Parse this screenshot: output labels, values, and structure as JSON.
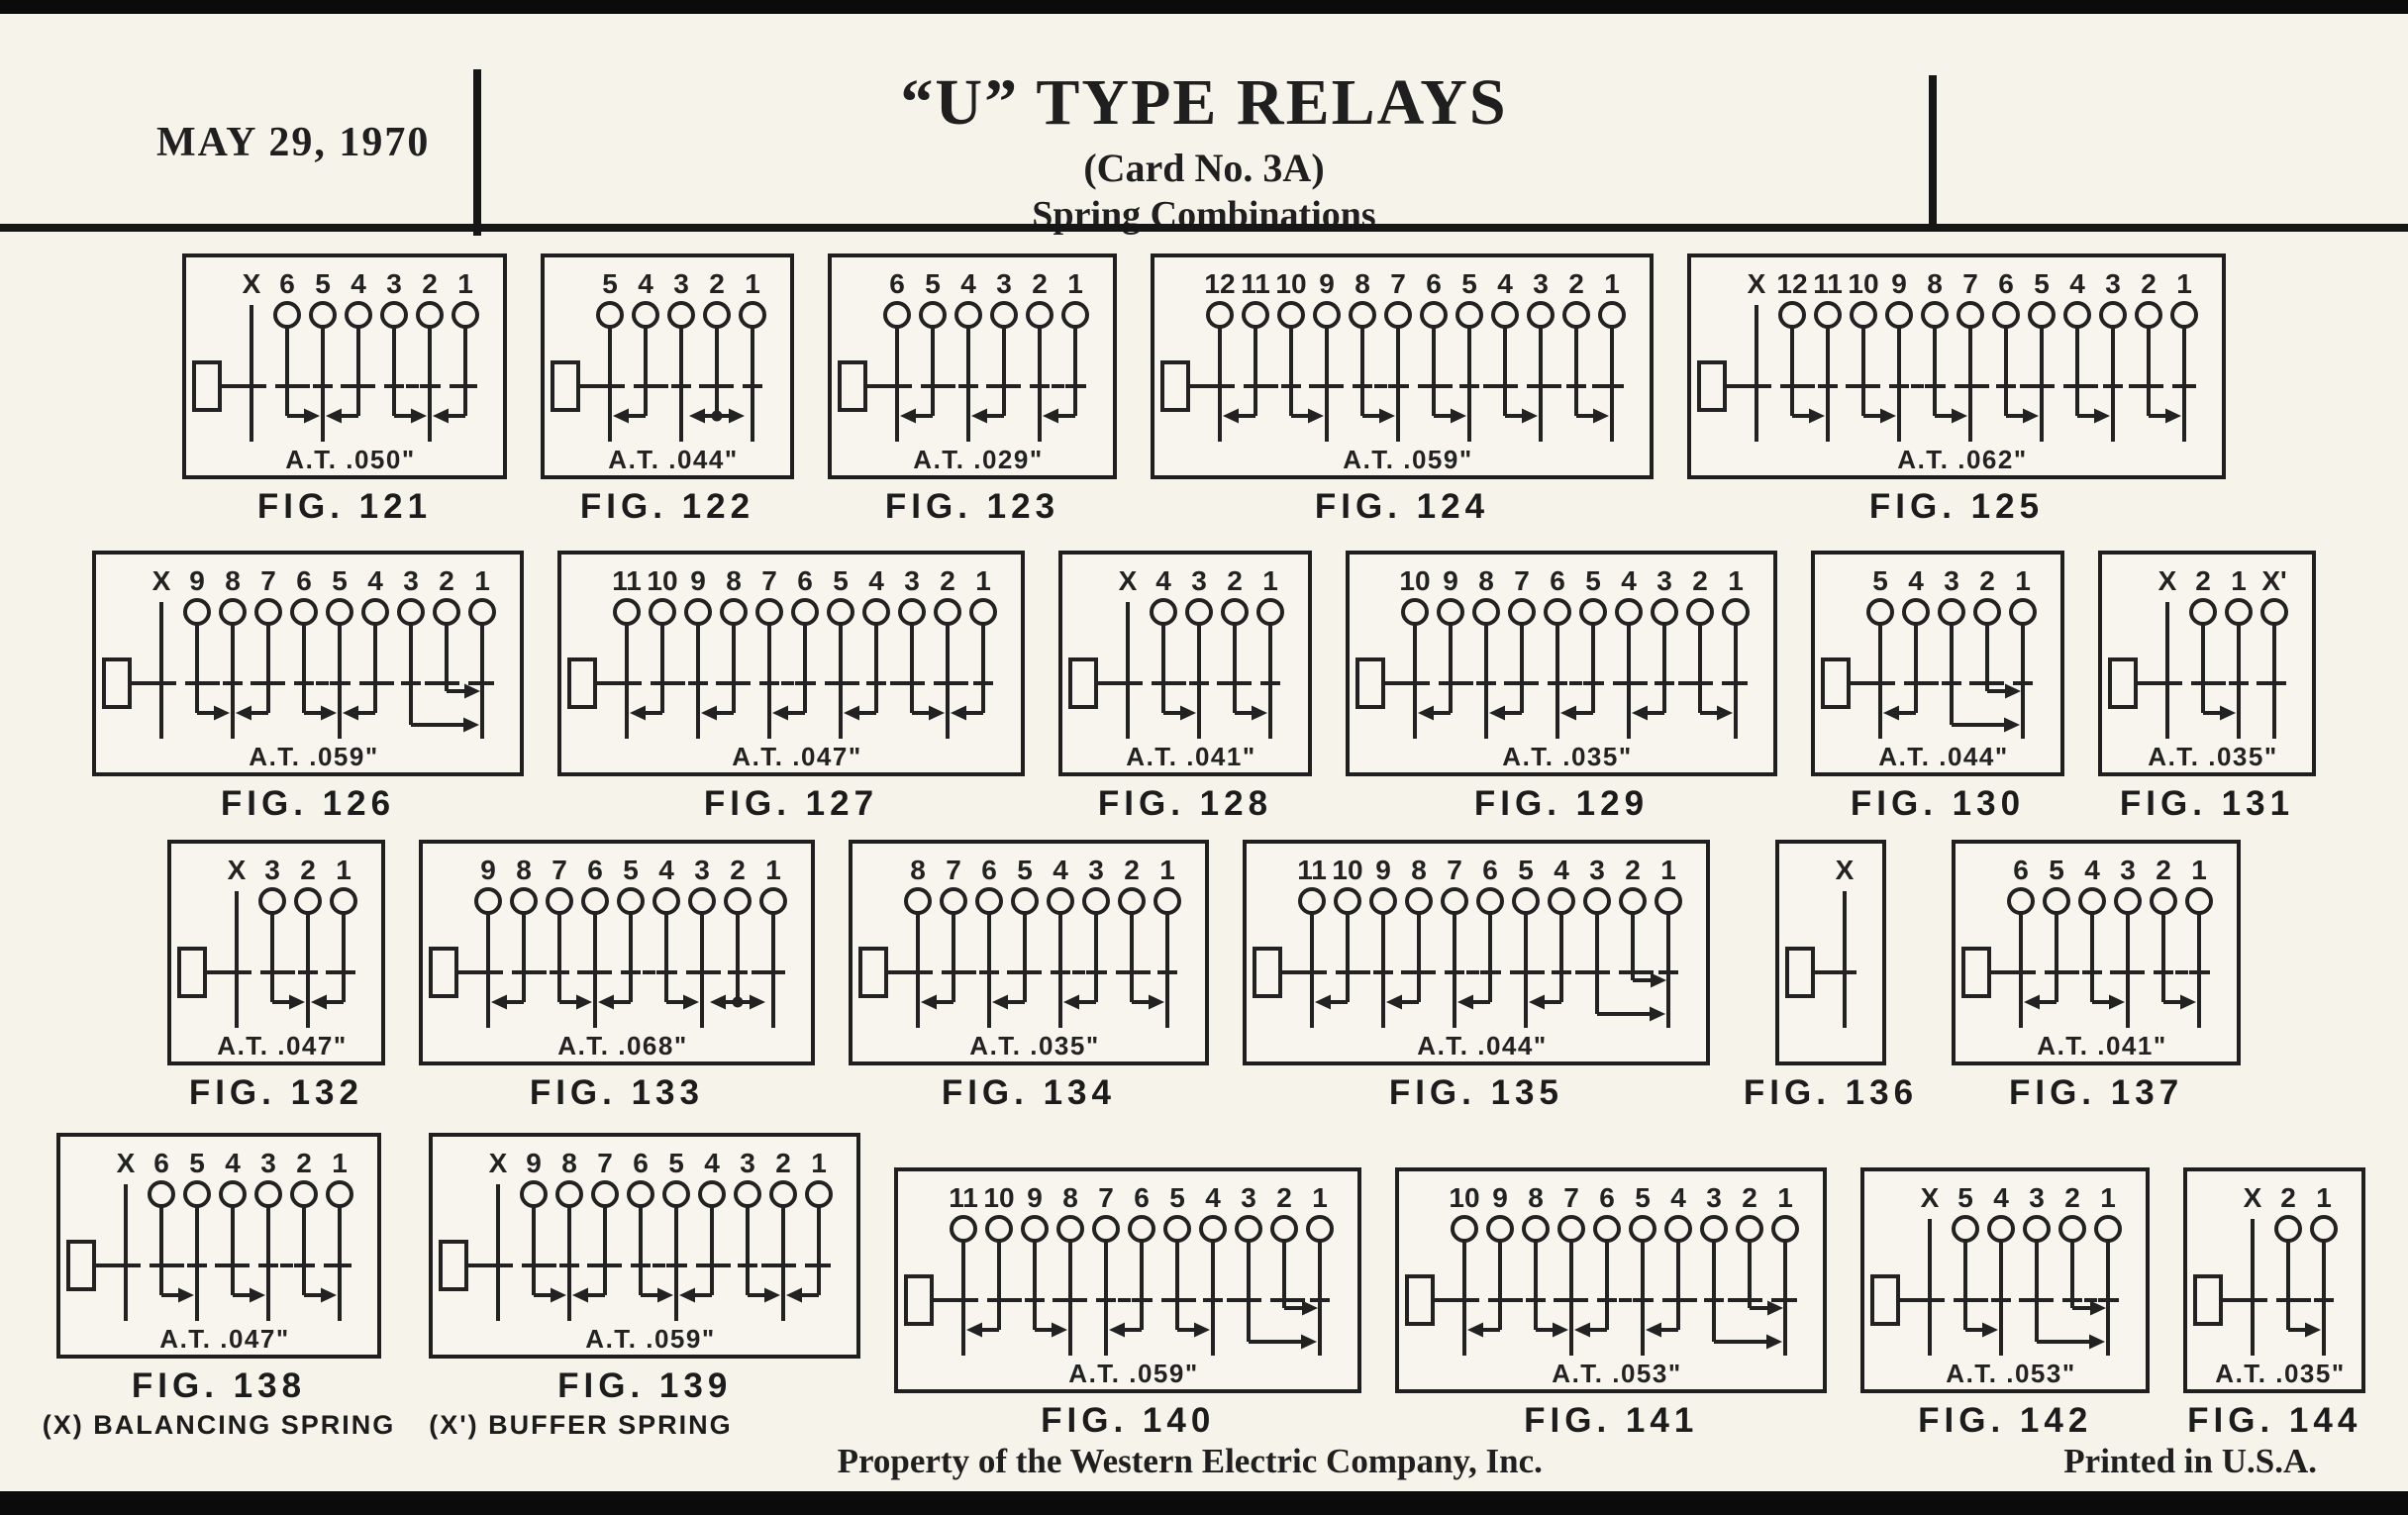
{
  "page": {
    "date": "MAY 29, 1970",
    "title": "“U” TYPE RELAYS",
    "card_no": "(Card No. 3A)",
    "subtitle": "Spring Combinations",
    "footer_center": "Property of the Western Electric Company, Inc.",
    "footer_right": "Printed in U.S.A.",
    "ink_color": "#222222",
    "paper_color": "#f6f3ea"
  },
  "figures": [
    {
      "row": 1,
      "caption": "FIG. 121",
      "at": "A.T. .050\"",
      "terminals": [
        "X",
        "6",
        "5",
        "4",
        "3",
        "2",
        "1"
      ],
      "arrows": [
        {
          "i": 1,
          "d": "R"
        },
        {
          "i": 3,
          "d": "L"
        },
        {
          "i": 4,
          "d": "R"
        },
        {
          "i": 6,
          "d": "L"
        }
      ]
    },
    {
      "row": 1,
      "caption": "FIG. 122",
      "at": "A.T. .044\"",
      "terminals": [
        "5",
        "4",
        "3",
        "2",
        "1"
      ],
      "arrows": [
        {
          "i": 1,
          "d": "L"
        },
        {
          "i": 3,
          "d": "LR"
        }
      ]
    },
    {
      "row": 1,
      "caption": "FIG. 123",
      "at": "A.T. .029\"",
      "terminals": [
        "6",
        "5",
        "4",
        "3",
        "2",
        "1"
      ],
      "arrows": [
        {
          "i": 1,
          "d": "L"
        },
        {
          "i": 3,
          "d": "L"
        },
        {
          "i": 5,
          "d": "L"
        }
      ]
    },
    {
      "row": 1,
      "caption": "FIG. 124",
      "at": "A.T. .059\"",
      "terminals": [
        "12",
        "11",
        "10",
        "9",
        "8",
        "7",
        "6",
        "5",
        "4",
        "3",
        "2",
        "1"
      ],
      "arrows": [
        {
          "i": 1,
          "d": "L"
        },
        {
          "i": 2,
          "d": "R"
        },
        {
          "i": 4,
          "d": "R"
        },
        {
          "i": 6,
          "d": "R"
        },
        {
          "i": 8,
          "d": "R"
        },
        {
          "i": 10,
          "d": "R"
        }
      ]
    },
    {
      "row": 1,
      "caption": "FIG. 125",
      "at": "A.T. .062\"",
      "terminals": [
        "X",
        "12",
        "11",
        "10",
        "9",
        "8",
        "7",
        "6",
        "5",
        "4",
        "3",
        "2",
        "1"
      ],
      "arrows": [
        {
          "i": 1,
          "d": "R"
        },
        {
          "i": 3,
          "d": "R"
        },
        {
          "i": 5,
          "d": "R"
        },
        {
          "i": 7,
          "d": "R"
        },
        {
          "i": 9,
          "d": "R"
        },
        {
          "i": 11,
          "d": "R"
        }
      ]
    },
    {
      "row": 2,
      "caption": "FIG. 126",
      "at": "A.T. .059\"",
      "terminals": [
        "X",
        "9",
        "8",
        "7",
        "6",
        "5",
        "4",
        "3",
        "2",
        "1"
      ],
      "arrows": [
        {
          "i": 1,
          "d": "R"
        },
        {
          "i": 3,
          "d": "L"
        },
        {
          "i": 4,
          "d": "R"
        },
        {
          "i": 6,
          "d": "L"
        },
        {
          "i": 7,
          "d": "R",
          "v": "long"
        },
        {
          "i": 8,
          "d": "R",
          "v": "mid"
        }
      ]
    },
    {
      "row": 2,
      "caption": "FIG. 127",
      "at": "A.T. .047\"",
      "terminals": [
        "11",
        "10",
        "9",
        "8",
        "7",
        "6",
        "5",
        "4",
        "3",
        "2",
        "1"
      ],
      "arrows": [
        {
          "i": 1,
          "d": "L"
        },
        {
          "i": 3,
          "d": "L"
        },
        {
          "i": 5,
          "d": "L"
        },
        {
          "i": 7,
          "d": "L"
        },
        {
          "i": 8,
          "d": "R"
        },
        {
          "i": 10,
          "d": "L"
        }
      ]
    },
    {
      "row": 2,
      "caption": "FIG. 128",
      "at": "A.T. .041\"",
      "terminals": [
        "X",
        "4",
        "3",
        "2",
        "1"
      ],
      "arrows": [
        {
          "i": 1,
          "d": "R"
        },
        {
          "i": 3,
          "d": "R"
        }
      ]
    },
    {
      "row": 2,
      "caption": "FIG. 129",
      "at": "A.T. .035\"",
      "terminals": [
        "10",
        "9",
        "8",
        "7",
        "6",
        "5",
        "4",
        "3",
        "2",
        "1"
      ],
      "arrows": [
        {
          "i": 1,
          "d": "L"
        },
        {
          "i": 3,
          "d": "L"
        },
        {
          "i": 5,
          "d": "L"
        },
        {
          "i": 7,
          "d": "L"
        },
        {
          "i": 8,
          "d": "R"
        }
      ]
    },
    {
      "row": 2,
      "caption": "FIG. 130",
      "at": "A.T. .044\"",
      "terminals": [
        "5",
        "4",
        "3",
        "2",
        "1"
      ],
      "arrows": [
        {
          "i": 1,
          "d": "L"
        },
        {
          "i": 2,
          "d": "R",
          "v": "long"
        },
        {
          "i": 3,
          "d": "R",
          "v": "mid"
        }
      ]
    },
    {
      "row": 2,
      "caption": "FIG. 131",
      "at": "A.T. .035\"",
      "terminals": [
        "X",
        "2",
        "1",
        "X'"
      ],
      "arrows": [
        {
          "i": 1,
          "d": "R"
        }
      ]
    },
    {
      "row": 3,
      "caption": "FIG. 132",
      "at": "A.T. .047\"",
      "terminals": [
        "X",
        "3",
        "2",
        "1"
      ],
      "arrows": [
        {
          "i": 1,
          "d": "R"
        },
        {
          "i": 3,
          "d": "L"
        }
      ]
    },
    {
      "row": 3,
      "caption": "FIG. 133",
      "at": "A.T. .068\"",
      "terminals": [
        "9",
        "8",
        "7",
        "6",
        "5",
        "4",
        "3",
        "2",
        "1"
      ],
      "arrows": [
        {
          "i": 1,
          "d": "L"
        },
        {
          "i": 2,
          "d": "R"
        },
        {
          "i": 4,
          "d": "L"
        },
        {
          "i": 5,
          "d": "R"
        },
        {
          "i": 7,
          "d": "LR"
        }
      ]
    },
    {
      "row": 3,
      "caption": "FIG. 134",
      "at": "A.T. .035\"",
      "terminals": [
        "8",
        "7",
        "6",
        "5",
        "4",
        "3",
        "2",
        "1"
      ],
      "arrows": [
        {
          "i": 1,
          "d": "L"
        },
        {
          "i": 3,
          "d": "L"
        },
        {
          "i": 5,
          "d": "L"
        },
        {
          "i": 6,
          "d": "R"
        }
      ]
    },
    {
      "row": 3,
      "caption": "FIG. 135",
      "at": "A.T. .044\"",
      "terminals": [
        "11",
        "10",
        "9",
        "8",
        "7",
        "6",
        "5",
        "4",
        "3",
        "2",
        "1"
      ],
      "arrows": [
        {
          "i": 1,
          "d": "L"
        },
        {
          "i": 3,
          "d": "L"
        },
        {
          "i": 5,
          "d": "L"
        },
        {
          "i": 7,
          "d": "L"
        },
        {
          "i": 8,
          "d": "R",
          "v": "long"
        },
        {
          "i": 9,
          "d": "R",
          "v": "mid"
        }
      ]
    },
    {
      "row": 3,
      "caption": "FIG. 136",
      "at": null,
      "terminals": [
        "X"
      ],
      "arrows": []
    },
    {
      "row": 3,
      "caption": "FIG. 137",
      "at": "A.T. .041\"",
      "terminals": [
        "6",
        "5",
        "4",
        "3",
        "2",
        "1"
      ],
      "arrows": [
        {
          "i": 1,
          "d": "L"
        },
        {
          "i": 2,
          "d": "R"
        },
        {
          "i": 4,
          "d": "R"
        }
      ]
    },
    {
      "row": 4,
      "caption": "FIG. 138",
      "at": "A.T. .047\"",
      "terminals": [
        "X",
        "6",
        "5",
        "4",
        "3",
        "2",
        "1"
      ],
      "note": "(X) BALANCING SPRING",
      "arrows": [
        {
          "i": 1,
          "d": "R"
        },
        {
          "i": 3,
          "d": "R"
        },
        {
          "i": 5,
          "d": "R"
        }
      ]
    },
    {
      "row": 4,
      "caption": "FIG. 139",
      "at": "A.T. .059\"",
      "terminals": [
        "X",
        "9",
        "8",
        "7",
        "6",
        "5",
        "4",
        "3",
        "2",
        "1"
      ],
      "note": "(X') BUFFER SPRING",
      "arrows": [
        {
          "i": 1,
          "d": "R"
        },
        {
          "i": 3,
          "d": "L"
        },
        {
          "i": 4,
          "d": "R"
        },
        {
          "i": 6,
          "d": "L"
        },
        {
          "i": 7,
          "d": "R"
        },
        {
          "i": 9,
          "d": "L"
        }
      ]
    },
    {
      "row": 4,
      "caption": "FIG. 140",
      "at": "A.T. .059\"",
      "terminals": [
        "11",
        "10",
        "9",
        "8",
        "7",
        "6",
        "5",
        "4",
        "3",
        "2",
        "1"
      ],
      "arrows": [
        {
          "i": 1,
          "d": "L"
        },
        {
          "i": 2,
          "d": "R"
        },
        {
          "i": 5,
          "d": "L"
        },
        {
          "i": 6,
          "d": "R"
        },
        {
          "i": 8,
          "d": "R",
          "v": "long"
        },
        {
          "i": 9,
          "d": "R",
          "v": "mid"
        }
      ]
    },
    {
      "row": 4,
      "caption": "FIG. 141",
      "at": "A.T. .053\"",
      "terminals": [
        "10",
        "9",
        "8",
        "7",
        "6",
        "5",
        "4",
        "3",
        "2",
        "1"
      ],
      "arrows": [
        {
          "i": 1,
          "d": "L"
        },
        {
          "i": 2,
          "d": "R"
        },
        {
          "i": 4,
          "d": "L"
        },
        {
          "i": 6,
          "d": "L"
        },
        {
          "i": 7,
          "d": "R",
          "v": "long"
        },
        {
          "i": 8,
          "d": "R",
          "v": "mid"
        }
      ]
    },
    {
      "row": 4,
      "caption": "FIG. 142",
      "at": "A.T. .053\"",
      "terminals": [
        "X",
        "5",
        "4",
        "3",
        "2",
        "1"
      ],
      "arrows": [
        {
          "i": 1,
          "d": "R"
        },
        {
          "i": 3,
          "d": "R",
          "v": "long"
        },
        {
          "i": 4,
          "d": "R",
          "v": "mid"
        }
      ]
    },
    {
      "row": 4,
      "caption": "FIG. 144",
      "at": "A.T. .035\"",
      "terminals": [
        "X",
        "2",
        "1"
      ],
      "arrows": [
        {
          "i": 1,
          "d": "R"
        }
      ]
    }
  ]
}
